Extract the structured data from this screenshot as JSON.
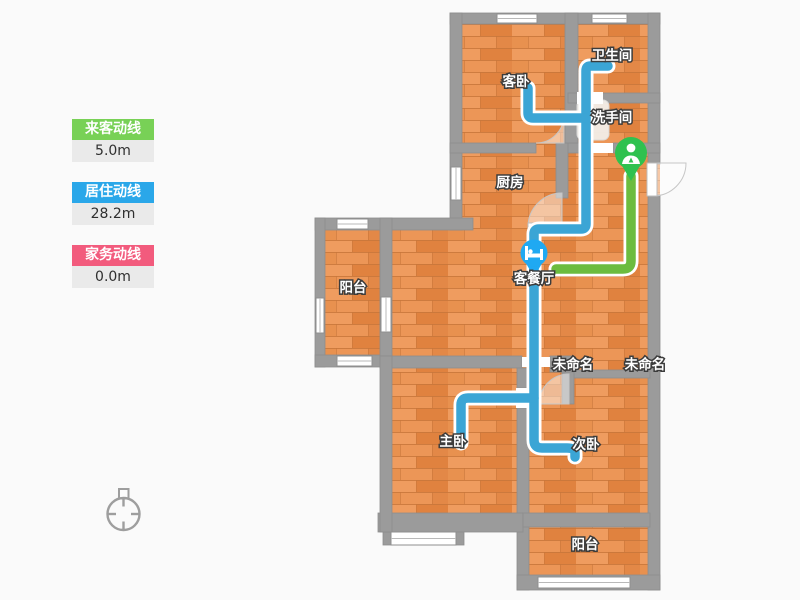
{
  "legend": {
    "items": [
      {
        "label": "来客动线",
        "value": "5.0m",
        "color": "#78D156"
      },
      {
        "label": "居住动线",
        "value": "28.2m",
        "color": "#2AA7E9"
      },
      {
        "label": "家务动线",
        "value": "0.0m",
        "color": "#F25B7D"
      }
    ]
  },
  "plan": {
    "rooms": [
      {
        "label": "客卧"
      },
      {
        "label": "卫生间"
      },
      {
        "label": "洗手间"
      },
      {
        "label": "厨房"
      },
      {
        "label": "客餐厅"
      },
      {
        "label": "阳台"
      },
      {
        "label": "未命名"
      },
      {
        "label": "未命名"
      },
      {
        "label": "主卧"
      },
      {
        "label": "次卧"
      },
      {
        "label": "阳台"
      }
    ],
    "markers": [
      {
        "name": "entrance-pin",
        "icon": "person-icon",
        "color": "#2FC14F"
      },
      {
        "name": "living-dining-poi",
        "icon": "bed-icon",
        "color": "#1FA9F2"
      }
    ],
    "colors": {
      "wall": "#9B9B9B",
      "floor": "#E8914F",
      "route_visitor": "#6CBC3F",
      "route_resident": "#3BA5D5",
      "background": "#FAFAFA"
    }
  }
}
